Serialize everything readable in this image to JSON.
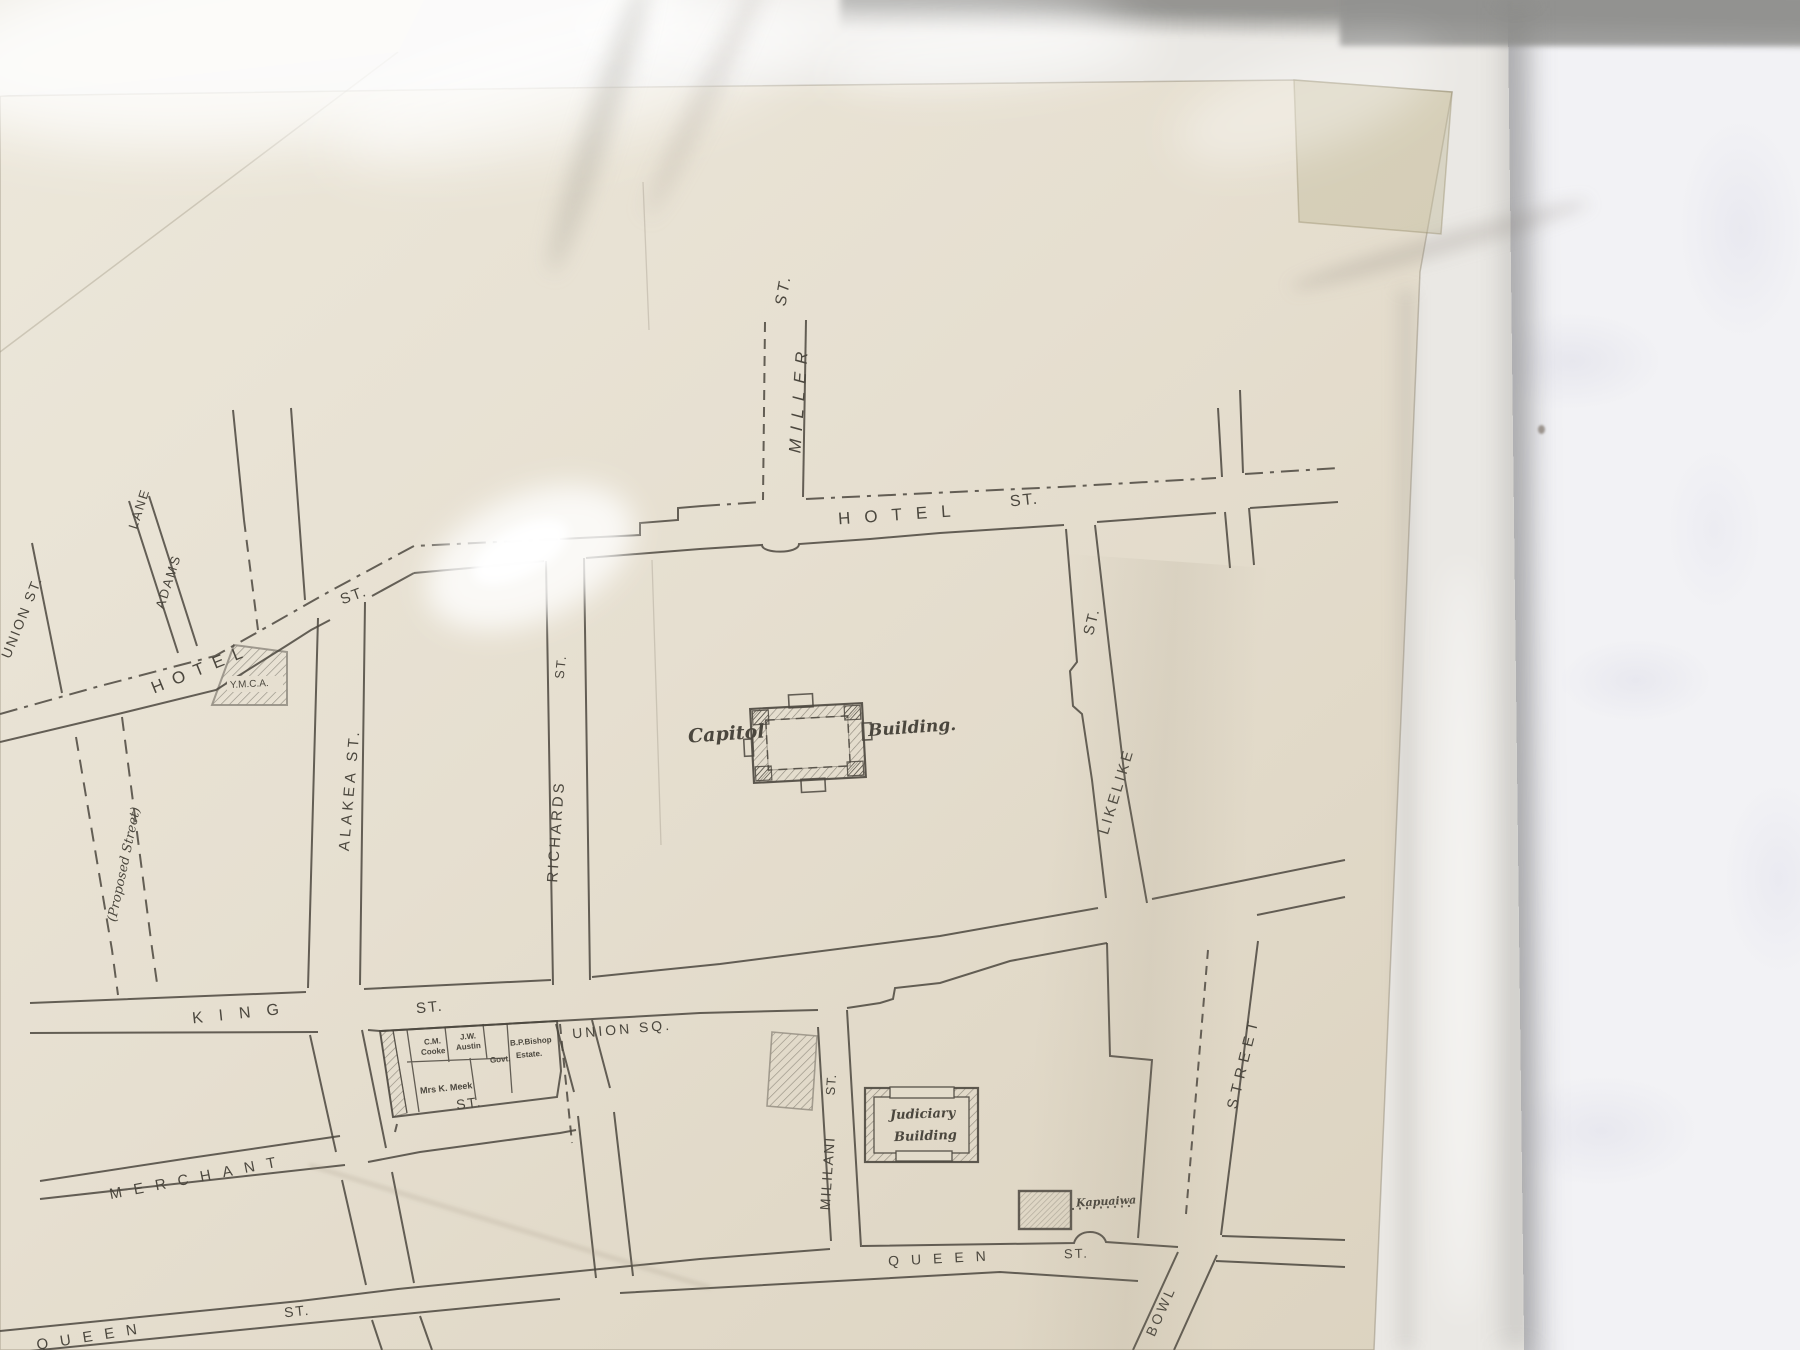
{
  "photo": {
    "subject": "hand-drawn street map of the Capitol district, Honolulu, in a clear plastic sleeve lying on a white cloth"
  },
  "colors": {
    "paper": "#e6e0d2",
    "paper_dark": "#dcd3c0",
    "ink": "#4b473e",
    "sleeve": "#eae8e4",
    "cloth": "#f2f2f5",
    "tape": "#c4bd9e"
  },
  "labels": {
    "miller": {
      "name": "MILLER",
      "st": "ST."
    },
    "hotel_main": {
      "name": "HOTEL",
      "st": "ST."
    },
    "hotel_left": {
      "name": "HOTEL",
      "st": "ST."
    },
    "adams_lane": {
      "word1": "ADAMS",
      "word2": "LANE"
    },
    "union_left": {
      "name": "UNION ST."
    },
    "proposed": {
      "name": "(Proposed Street)"
    },
    "alakea": {
      "name": "ALAKEA ST."
    },
    "richards": {
      "name": "RICHARDS",
      "st": "ST."
    },
    "likelike": {
      "name": "LIKELIKE",
      "st": "ST."
    },
    "king": {
      "name": "KING",
      "st": "ST."
    },
    "union_sq": {
      "name": "UNION SQ."
    },
    "merchant": {
      "name": "MERCHANT",
      "st": "ST."
    },
    "mililani": {
      "name": "MILILANI",
      "st": "ST."
    },
    "queen_mid": {
      "name": "QUEEN",
      "st": "ST."
    },
    "queen_sw": {
      "name": "QUEEN",
      "st": "ST."
    },
    "punchbowl": {
      "street": "STREET",
      "bowl": "BOWL"
    },
    "ymca": {
      "name": "Y.M.C.A."
    },
    "capitol": {
      "word1": "Capitol",
      "word2": "Building."
    },
    "judiciary": {
      "word1": "Judiciary",
      "word2": "Building"
    },
    "kapuaiwa": {
      "name": "Kapuaiwa"
    },
    "parcels": {
      "cm": "C.M.",
      "cooke": "Cooke",
      "jw": "J.W.",
      "austin": "Austin",
      "govt": "Govt.",
      "bishop": "B.P.Bishop",
      "estate": "Estate.",
      "meek": "Mrs K. Meek"
    }
  }
}
